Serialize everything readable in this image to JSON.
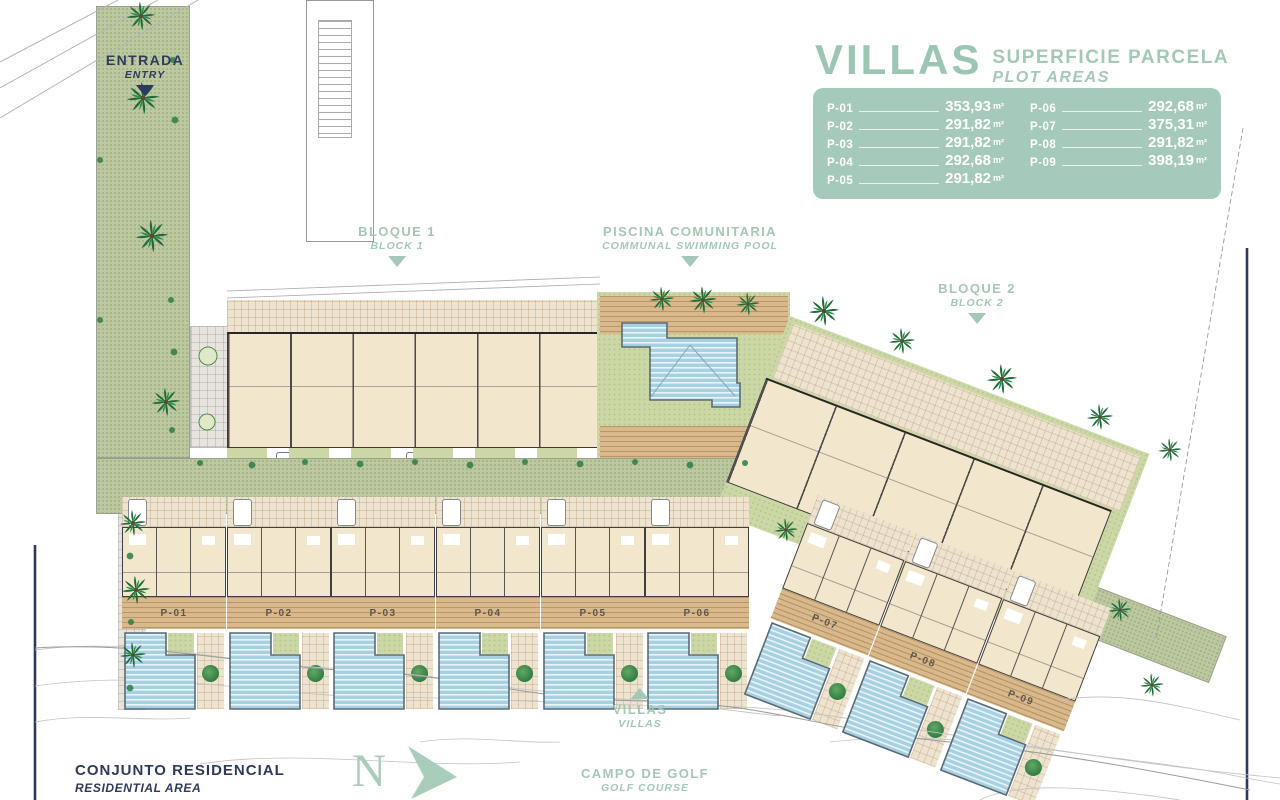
{
  "legend": {
    "title": "VILLAS",
    "subtitle_line1": "SUPERFICIE PARCELA",
    "subtitle_line2": "PLOT AREAS",
    "plots_left": [
      {
        "id": "P-01",
        "area": "353,93",
        "unit": "m²"
      },
      {
        "id": "P-02",
        "area": "291,82",
        "unit": "m²"
      },
      {
        "id": "P-03",
        "area": "291,82",
        "unit": "m²"
      },
      {
        "id": "P-04",
        "area": "292,68",
        "unit": "m²"
      },
      {
        "id": "P-05",
        "area": "291,82",
        "unit": "m²"
      }
    ],
    "plots_right": [
      {
        "id": "P-06",
        "area": "292,68",
        "unit": "m²"
      },
      {
        "id": "P-07",
        "area": "375,31",
        "unit": "m²"
      },
      {
        "id": "P-08",
        "area": "291,82",
        "unit": "m²"
      },
      {
        "id": "P-09",
        "area": "398,19",
        "unit": "m²"
      }
    ]
  },
  "markers": {
    "entrada": {
      "title": "ENTRADA",
      "subtitle": "ENTRY"
    },
    "bloque1": {
      "title": "BLOQUE 1",
      "subtitle": "BLOCK 1"
    },
    "piscina": {
      "title": "PISCINA COMUNITARIA",
      "subtitle": "COMMUNAL SWIMMING POOL"
    },
    "bloque2": {
      "title": "BLOQUE 2",
      "subtitle": "BLOCK 2"
    },
    "villas": {
      "title": "VILLAS",
      "subtitle": "VILLAS"
    },
    "campo": {
      "title": "CAMPO DE GOLF",
      "subtitle": "GOLF COURSE"
    },
    "conjunto": {
      "title": "CONJUNTO RESIDENCIAL",
      "subtitle": "RESIDENTIAL AREA"
    }
  },
  "plan": {
    "villa_labels": [
      "P-01",
      "P-02",
      "P-03",
      "P-04",
      "P-05",
      "P-06",
      "P-07",
      "P-08",
      "P-09"
    ]
  },
  "north": {
    "label": "N"
  },
  "colors": {
    "sage": "#a3c8b6",
    "navy": "#2e3a5c",
    "pool_blue": "#a7d0e3",
    "lawn_green": "#cbd8a6",
    "deck_tan": "#d9b98c",
    "plan_beige": "#f2e7cd"
  }
}
